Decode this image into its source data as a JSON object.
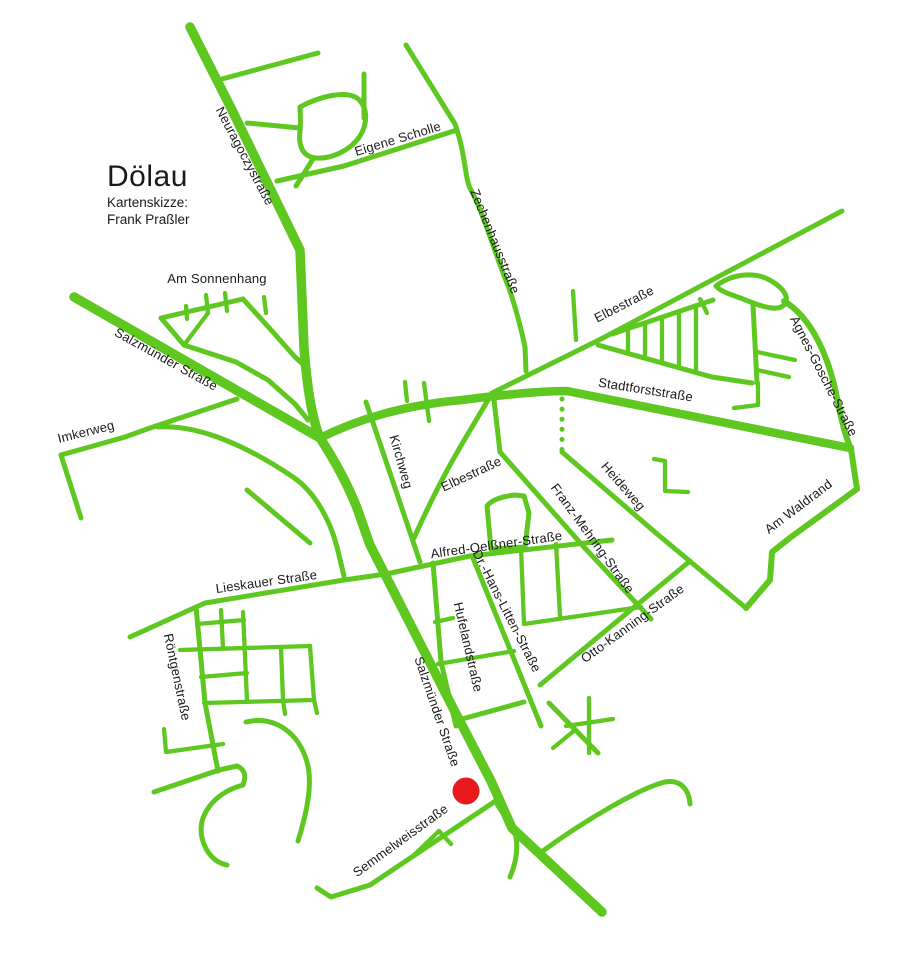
{
  "map": {
    "title": "Dölau",
    "subtitle_line1": "Kartenskizze:",
    "subtitle_line2": "Frank Praßler",
    "colors": {
      "street": "#5ec720",
      "marker": "#e8191a",
      "label": "#1a1a1a",
      "background": "#ffffff"
    },
    "marker": {
      "meaning": "highlighted-location-dot"
    },
    "street_labels": [
      {
        "text": "Neuragoczystraße"
      },
      {
        "text": "Eigene Scholle"
      },
      {
        "text": "Zechenhausstraße"
      },
      {
        "text": "Am Sonnenhang"
      },
      {
        "text": "Salzmünder Straße"
      },
      {
        "text": "Elbestraße"
      },
      {
        "text": "Agnes-Gosche-Straße"
      },
      {
        "text": "Stadtforststraße"
      },
      {
        "text": "Imkerweg"
      },
      {
        "text": "Kirchweg"
      },
      {
        "text": "Elbestraße"
      },
      {
        "text": "Heideweg"
      },
      {
        "text": "Franz-Mehring-Straße"
      },
      {
        "text": "Am Waldrand"
      },
      {
        "text": "Alfred-Oelßner-Straße"
      },
      {
        "text": "Lieskauer Straße"
      },
      {
        "text": "Dr.-Hans-Litten-Straße"
      },
      {
        "text": "Hufelandstraße"
      },
      {
        "text": "Otto-Kanning-Straße"
      },
      {
        "text": "Röntgenstraße"
      },
      {
        "text": "Salzmünder Straße"
      },
      {
        "text": "Semmelweisstraße"
      }
    ]
  }
}
